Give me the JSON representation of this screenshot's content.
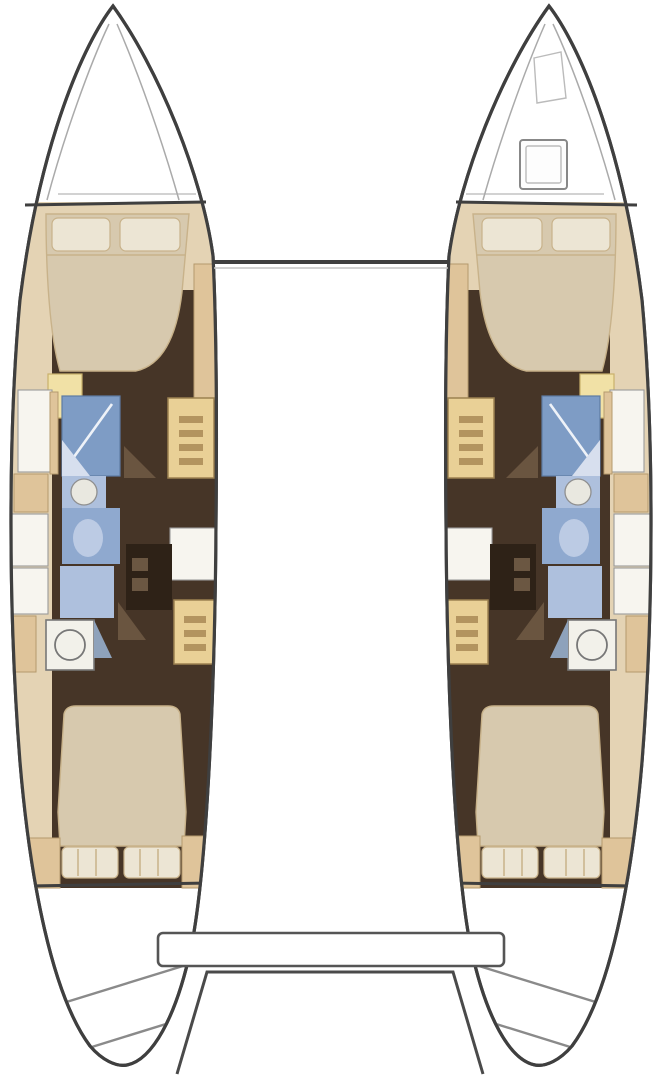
{
  "canvas": {
    "width": 662,
    "height": 1080,
    "background": "#ffffff"
  },
  "diagram": {
    "type": "catamaran-floor-plan",
    "title": "Catamaran interior layout plan: twin hulls, 4 double cabins and 4 heads",
    "hulls": [
      {
        "name": "port",
        "rooms": [
          "forward-double-cabin",
          "forward-head-shower",
          "forward-head-sink",
          "forward-head-toilet",
          "companionway-stairs-forward",
          "mid-cabinet",
          "companionway-stairs-aft",
          "aft-head-sink",
          "aft-head-toilet",
          "aft-double-cabin",
          "swim-platform-steps"
        ]
      },
      {
        "name": "starboard",
        "rooms": [
          "forward-double-cabin",
          "forward-head-shower",
          "forward-head-sink",
          "forward-head-toilet",
          "companionway-stairs-forward",
          "mid-cabinet",
          "companionway-stairs-aft",
          "aft-head-sink",
          "aft-head-toilet",
          "aft-double-cabin",
          "swim-platform-steps",
          "foredeck-hatch",
          "windlass-locker"
        ]
      }
    ],
    "shared_elements": [
      "forward-crossbeam",
      "aft-bench",
      "aft-cockpit-platform"
    ]
  },
  "colors": {
    "outline": "#3f3f3f",
    "light_line": "#c4c4c4",
    "interior_tan": "#e4d3b4",
    "wood_tan": "#dfc49a",
    "floor_brown": "#463527",
    "vanity_dark": "#2e2217",
    "door_wedge": "#6a5540",
    "bed_cream": "#d7c9ae",
    "pillow_cream": "#ece5d4",
    "pillow_edge": "#c8b28a",
    "step_yellow": "#f1e1a6",
    "locker_white": "#f7f5ef",
    "shower_blue": "#7e9cc5",
    "toilet_blue": "#8fa9cf",
    "counter_blue": "#aec0dd",
    "fixture_white": "#e9e8e0",
    "stairs_tan": "#e9d096",
    "rung_brown": "#b3945f"
  }
}
